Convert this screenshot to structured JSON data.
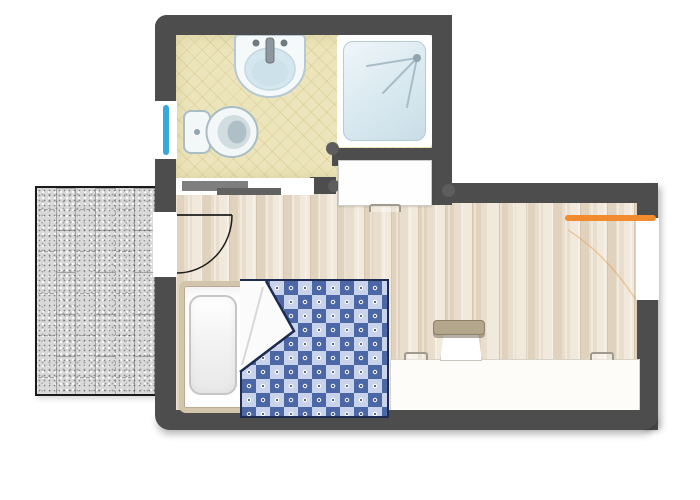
{
  "plan": {
    "kind": "floor-plan",
    "rooms": [
      "bathroom",
      "main-room",
      "patio"
    ],
    "fixtures": [
      "sink",
      "toilet",
      "shower",
      "sliding-bathroom-door",
      "entry-door",
      "bathroom-window",
      "main-window",
      "wardrobe",
      "bed",
      "pillow",
      "checkered-blanket",
      "desk",
      "chair",
      "curtain-rod"
    ]
  },
  "patterns": {
    "patio_columns": 6,
    "patio_tile_height_px": 42,
    "blanket_square_px": 14
  },
  "colors": {
    "wall": "#4d4d4d",
    "bathroom-floor": "#ece4ba",
    "wood-floor": "#e9decd",
    "wood-floor-dark": "#e0d2bd",
    "wood-floor-light": "#f1e9db",
    "patio-tile": "#d9d9d9",
    "patio-grout": "#a3a3a3",
    "patio-border": "#1b1b1b",
    "shower-fill": "#dcebf1",
    "shower-stroke": "#b3ccd8",
    "fixture-fill": "#f4f8f9",
    "fixture-stroke": "#a9bdc7",
    "basin-fill": "#d5e7ee",
    "blanket-dark": "#4b67a5",
    "blanket-light": "#c9d4ec",
    "blanket-border": "#1f2c52",
    "window-blue": "#35a8e0",
    "accent-orange": "#f28a2e",
    "bed-frame": "#d2c5ac",
    "chair-back": "#b3a68c",
    "door-stroke": "#1d1d1d",
    "slider-light": "#7e7e7e",
    "slider-dark": "#616161",
    "handle-gray": "#a09a8e"
  }
}
